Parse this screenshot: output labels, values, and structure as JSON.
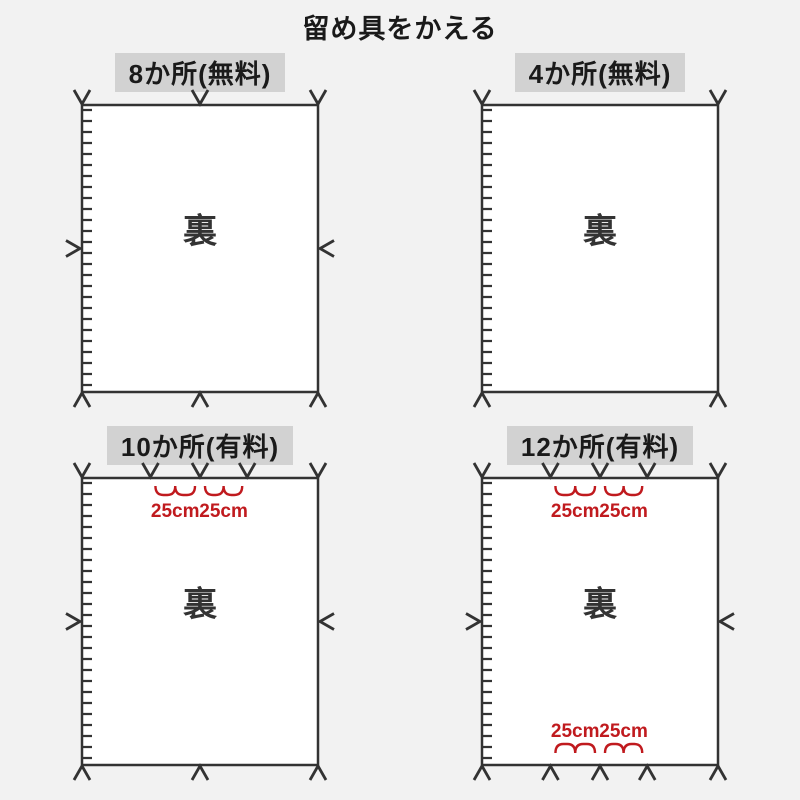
{
  "title": "留め具をかえる",
  "colors": {
    "background": "#f2f2f2",
    "line": "#333333",
    "label_bg": "#d2d2d2",
    "panel_fill": "#ffffff",
    "accent_red": "#c01a1e"
  },
  "panels": [
    {
      "id": "8-spots-free",
      "label": "8か所(無料)",
      "back_label": "裏",
      "zipper_edge": "left",
      "top_fasteners": [
        0,
        0.5,
        1
      ],
      "bottom_fasteners": [
        0,
        0.5,
        1
      ],
      "left_fastener": true,
      "right_fastener": true,
      "top_measures": [],
      "bottom_measures": []
    },
    {
      "id": "4-spots-free",
      "label": "4か所(無料)",
      "back_label": "裏",
      "zipper_edge": "left",
      "top_fasteners": [
        0,
        1
      ],
      "bottom_fasteners": [
        0,
        1
      ],
      "left_fastener": false,
      "right_fastener": false,
      "top_measures": [],
      "bottom_measures": []
    },
    {
      "id": "10-spots-paid",
      "label": "10か所(有料)",
      "back_label": "裏",
      "zipper_edge": "left",
      "top_fasteners": [
        0,
        0.29,
        0.5,
        0.7,
        1
      ],
      "bottom_fasteners": [
        0,
        0.5,
        1
      ],
      "left_fastener": true,
      "right_fastener": true,
      "top_measures": [
        {
          "between": [
            1,
            2
          ],
          "label": "25cm"
        },
        {
          "between": [
            2,
            3
          ],
          "label": "25cm"
        }
      ],
      "bottom_measures": []
    },
    {
      "id": "12-spots-paid",
      "label": "12か所(有料)",
      "back_label": "裏",
      "zipper_edge": "left",
      "top_fasteners": [
        0,
        0.29,
        0.5,
        0.7,
        1
      ],
      "bottom_fasteners": [
        0,
        0.29,
        0.5,
        0.7,
        1
      ],
      "left_fastener": true,
      "right_fastener": true,
      "top_measures": [
        {
          "between": [
            1,
            2
          ],
          "label": "25cm"
        },
        {
          "between": [
            2,
            3
          ],
          "label": "25cm"
        }
      ],
      "bottom_measures": [
        {
          "between": [
            1,
            2
          ],
          "label": "25cm"
        },
        {
          "between": [
            2,
            3
          ],
          "label": "25cm"
        }
      ]
    }
  ]
}
